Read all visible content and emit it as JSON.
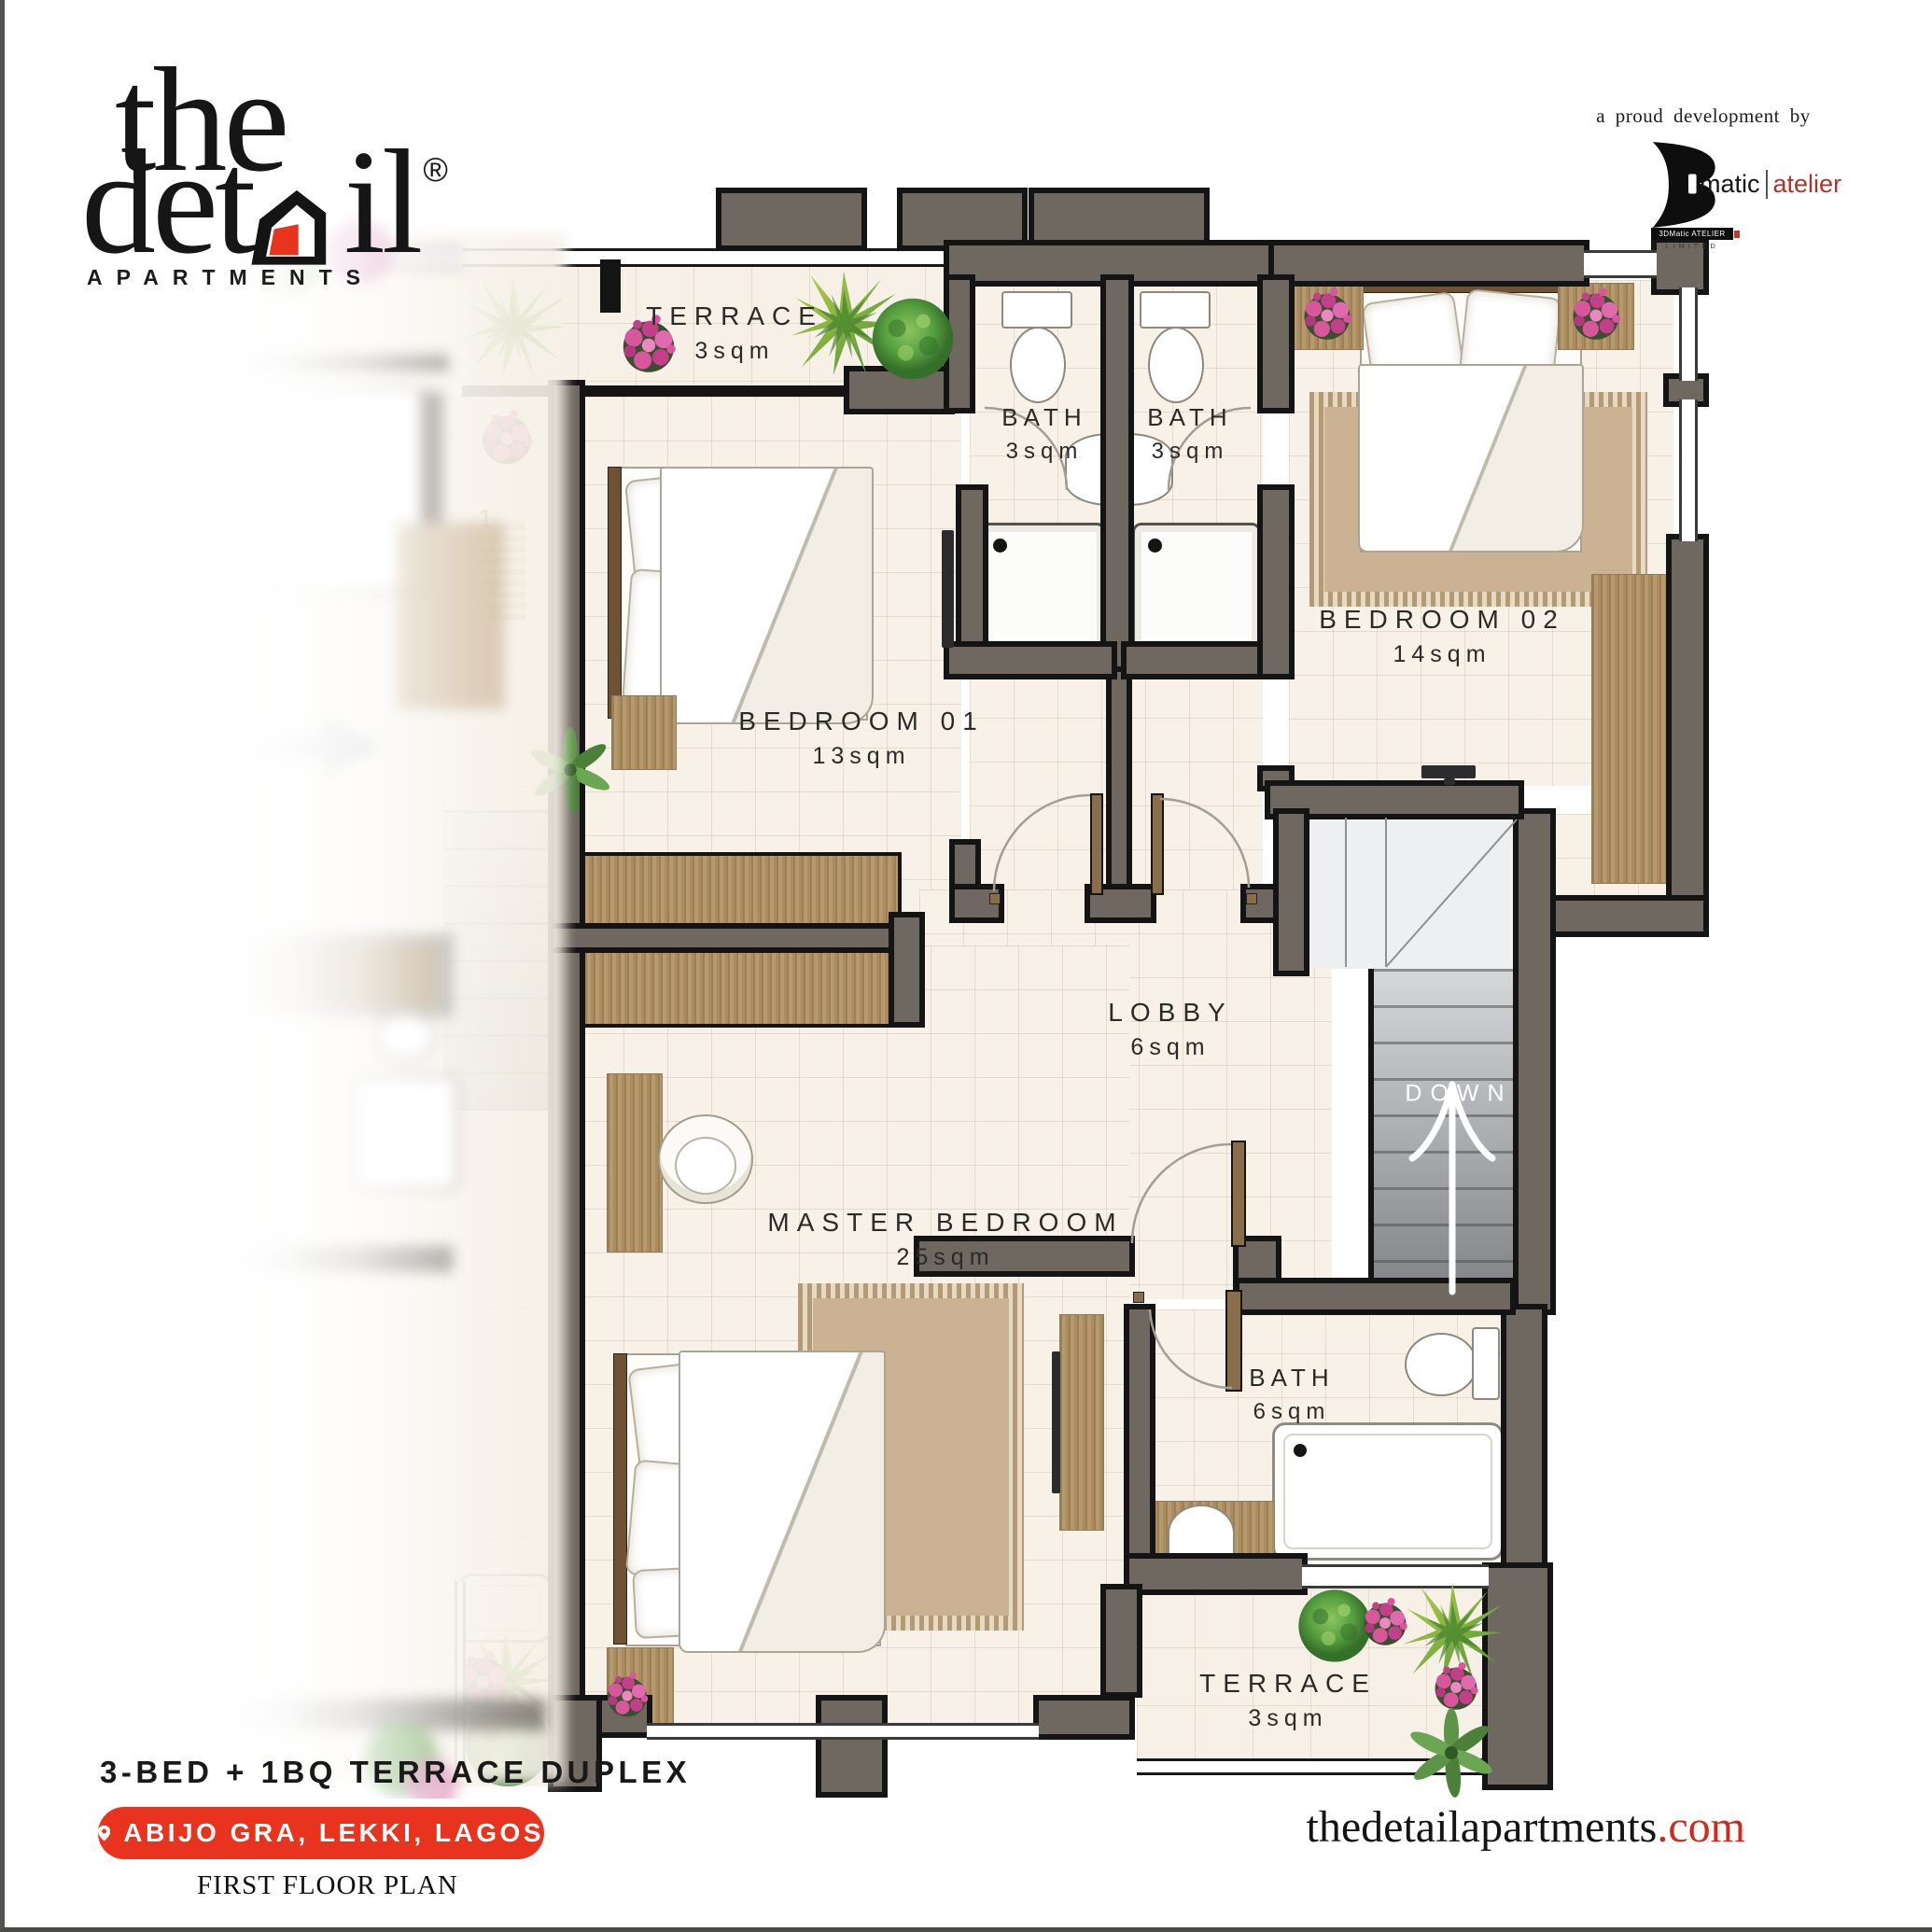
{
  "brand": {
    "logo_top": "the",
    "logo_mid_left": "det",
    "logo_mid_right": "il",
    "registered": "®",
    "subtitle": "APARTMENTS"
  },
  "developer": {
    "tagline": "a proud development by",
    "name_black": "matic",
    "name_red": "atelier",
    "bar_text": "3DMatic ATELIER",
    "bar_subtext": "LIMITED"
  },
  "plan": {
    "rooms": {
      "terrace_top": {
        "name": "TERRACE",
        "area": "3sqm"
      },
      "bath_a": {
        "name": "BATH",
        "area": "3sqm"
      },
      "bath_b": {
        "name": "BATH",
        "area": "3sqm"
      },
      "bedroom_02": {
        "name": "BEDROOM 02",
        "area": "14sqm"
      },
      "bedroom_01": {
        "name": "BEDROOM 01",
        "area": "13sqm"
      },
      "lobby": {
        "name": "LOBBY",
        "area": "6sqm"
      },
      "master": {
        "name": "MASTER BEDROOM",
        "area": "25sqm"
      },
      "bath_master": {
        "name": "BATH",
        "area": "6sqm"
      },
      "terrace_bottom": {
        "name": "TERRACE",
        "area": "3sqm"
      }
    },
    "stairs_label": "DOWN",
    "neighbor": {
      "partial_label": "1",
      "terrace_label": "TERRACE",
      "terrace_area": "3sqm"
    }
  },
  "footer": {
    "unit_title": "3-BED + 1BQ TERRACE DUPLEX",
    "location": "ABIJO GRA, LEKKI, LAGOS",
    "plan_name": "FIRST FLOOR PLAN",
    "website_black": "thedetailapartments",
    "website_red": ".com"
  },
  "colors": {
    "accent_red": "#e8341f",
    "wall": "#6e6860",
    "floor": "#f7f1e8",
    "website_red": "#cf2a1c",
    "atelier_red": "#a8362c"
  }
}
